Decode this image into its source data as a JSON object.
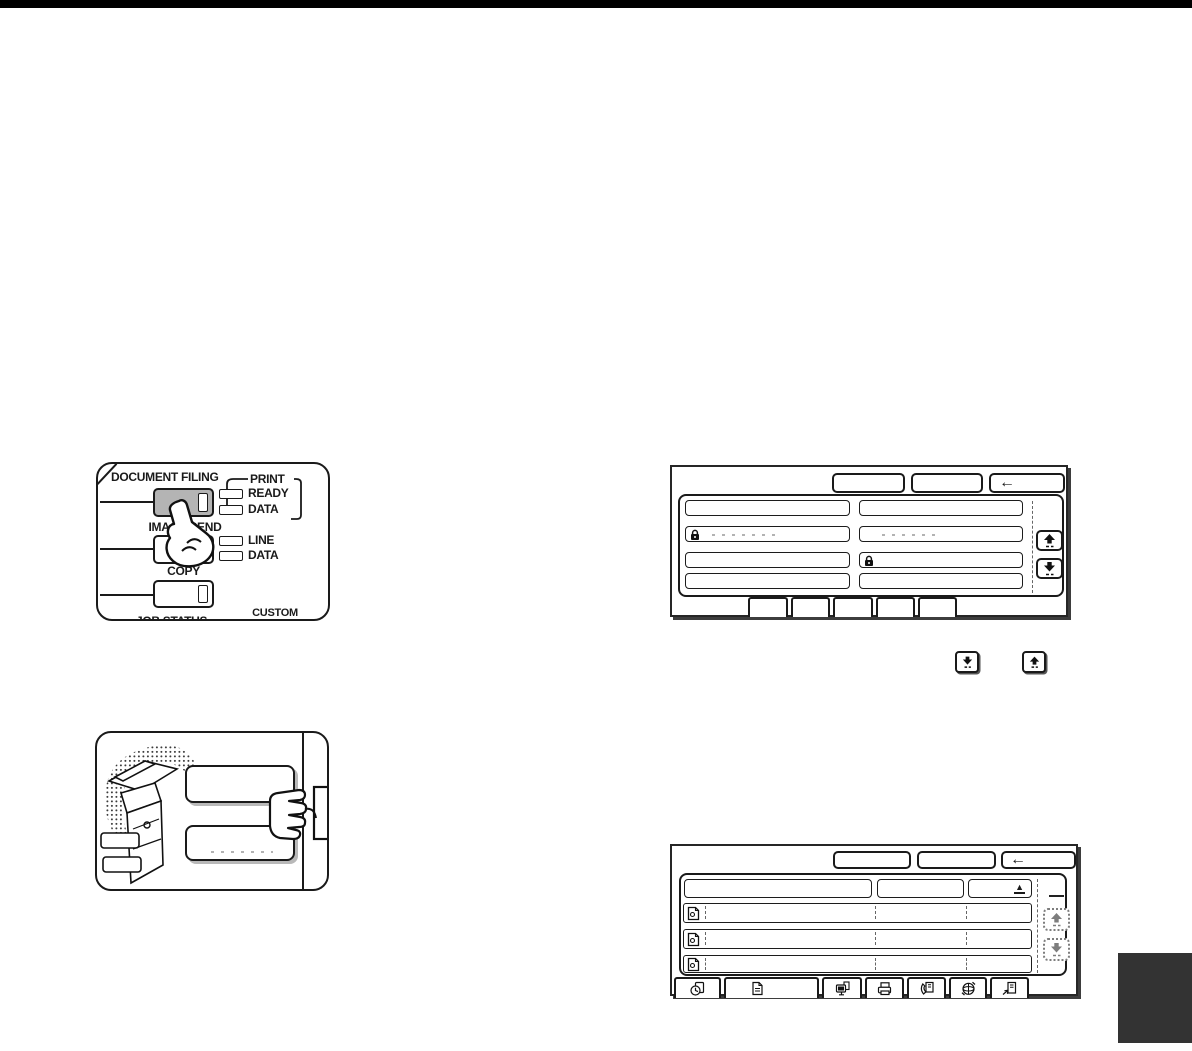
{
  "colors": {
    "top_bar": "#000000",
    "corner_tab": "#333333",
    "ink": "#1a1a1a",
    "pressed_key_fill": "#b4b4b4"
  },
  "control_panel": {
    "document_filing_label": "DOCUMENT FILING",
    "print_label": "PRINT",
    "ready_label": "READY",
    "print_data_label": "DATA",
    "image_send_label": "IMAGE SEND",
    "line_label": "LINE",
    "send_data_label": "DATA",
    "copy_label": "COPY",
    "job_status_label": "JOB STATUS",
    "custom_label": "CUSTOM",
    "settings_label": "SETTINGS"
  },
  "screen_top": {
    "back_glyph": "←"
  },
  "screen_bottom": {
    "back_glyph": "←",
    "sort_glyph": "▲"
  },
  "icons": {
    "lock": "lock-icon",
    "scroll_up": "scroll-up-icon",
    "scroll_down": "scroll-down-icon",
    "back_arrow": "back-arrow-icon",
    "sort_ascending": "sort-ascending-icon",
    "file_row": "file-icon",
    "bottom_tabs": [
      "quick-file-icon",
      "document-icon",
      "pc-icon",
      "printer-icon",
      "fax-icon",
      "internet-fax-icon",
      "pc-fax-icon"
    ]
  }
}
